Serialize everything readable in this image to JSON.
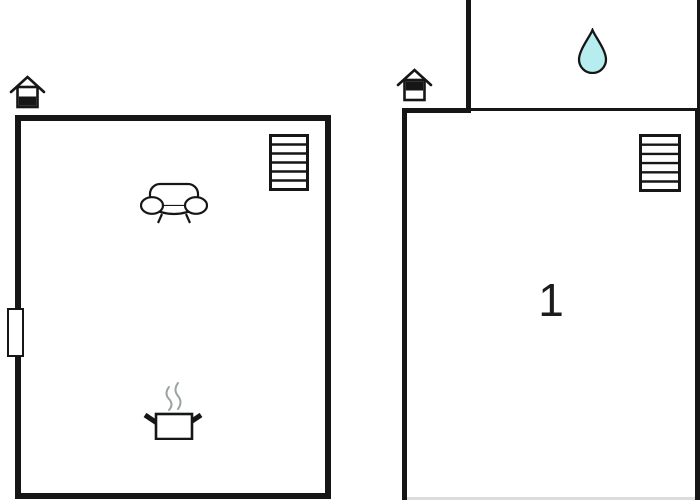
{
  "plan": {
    "background": "#ffffff",
    "wall_color": "#161616",
    "rooms": [
      {
        "id": "ground-floor-room",
        "label": "",
        "floor": "ground"
      },
      {
        "id": "first-floor-room",
        "label": "1",
        "floor": "first"
      }
    ]
  },
  "colors": {
    "wall": "#161616",
    "icon_stroke": "#161616",
    "water_drop_fill": "#b8edf0",
    "steam_stroke": "#9aa3a3",
    "faint_edge": "#dcdcdc"
  },
  "icons": {
    "ground_floor_house": "house-ground-floor-icon",
    "first_floor_house": "house-first-floor-icon",
    "stairs": "stairs-icon",
    "sofa": "sofa-icon",
    "cooking_pot": "cooking-pot-icon",
    "water_drop": "water-drop-icon",
    "window": "window-icon"
  }
}
